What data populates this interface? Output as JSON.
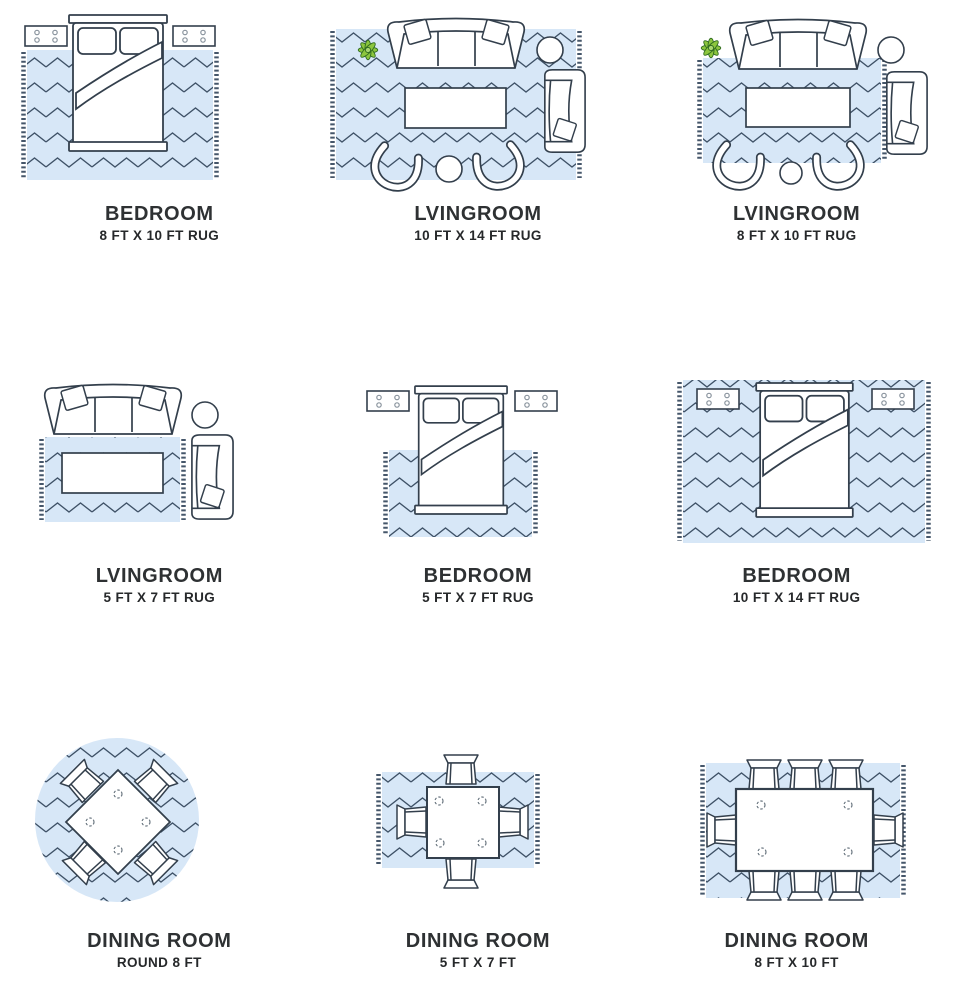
{
  "colors": {
    "rug_fill": "#d7e7f7",
    "zigzag_stroke": "#3e5166",
    "furniture_stroke": "#333f4c",
    "plant_green": "#8cc63e",
    "plant_outline": "#2f6b1f",
    "text": "#2e3133"
  },
  "cells": [
    {
      "room": "BEDROOM",
      "size": "8 FT X 10 FT RUG",
      "illustration": "bedroom-8x10-rug"
    },
    {
      "room": "LVINGROOM",
      "size": "10 FT X 14 FT RUG",
      "illustration": "livingroom-10x14-rug"
    },
    {
      "room": "LVINGROOM",
      "size": "8 FT X 10 FT RUG",
      "illustration": "livingroom-8x10-rug"
    },
    {
      "room": "LVINGROOM",
      "size": "5 FT X 7 FT RUG",
      "illustration": "livingroom-5x7-rug"
    },
    {
      "room": "BEDROOM",
      "size": "5 FT X 7 FT RUG",
      "illustration": "bedroom-5x7-rug"
    },
    {
      "room": "BEDROOM",
      "size": "10 FT X 14 FT RUG",
      "illustration": "bedroom-10x14-rug"
    },
    {
      "room": "DINING ROOM",
      "size": "ROUND 8 FT",
      "illustration": "diningroom-round-8ft-rug"
    },
    {
      "room": "DINING ROOM",
      "size": "5 FT X 7 FT",
      "illustration": "diningroom-5x7-rug"
    },
    {
      "room": "DINING ROOM",
      "size": "8 FT X 10 FT",
      "illustration": "diningroom-8x10-rug"
    }
  ]
}
